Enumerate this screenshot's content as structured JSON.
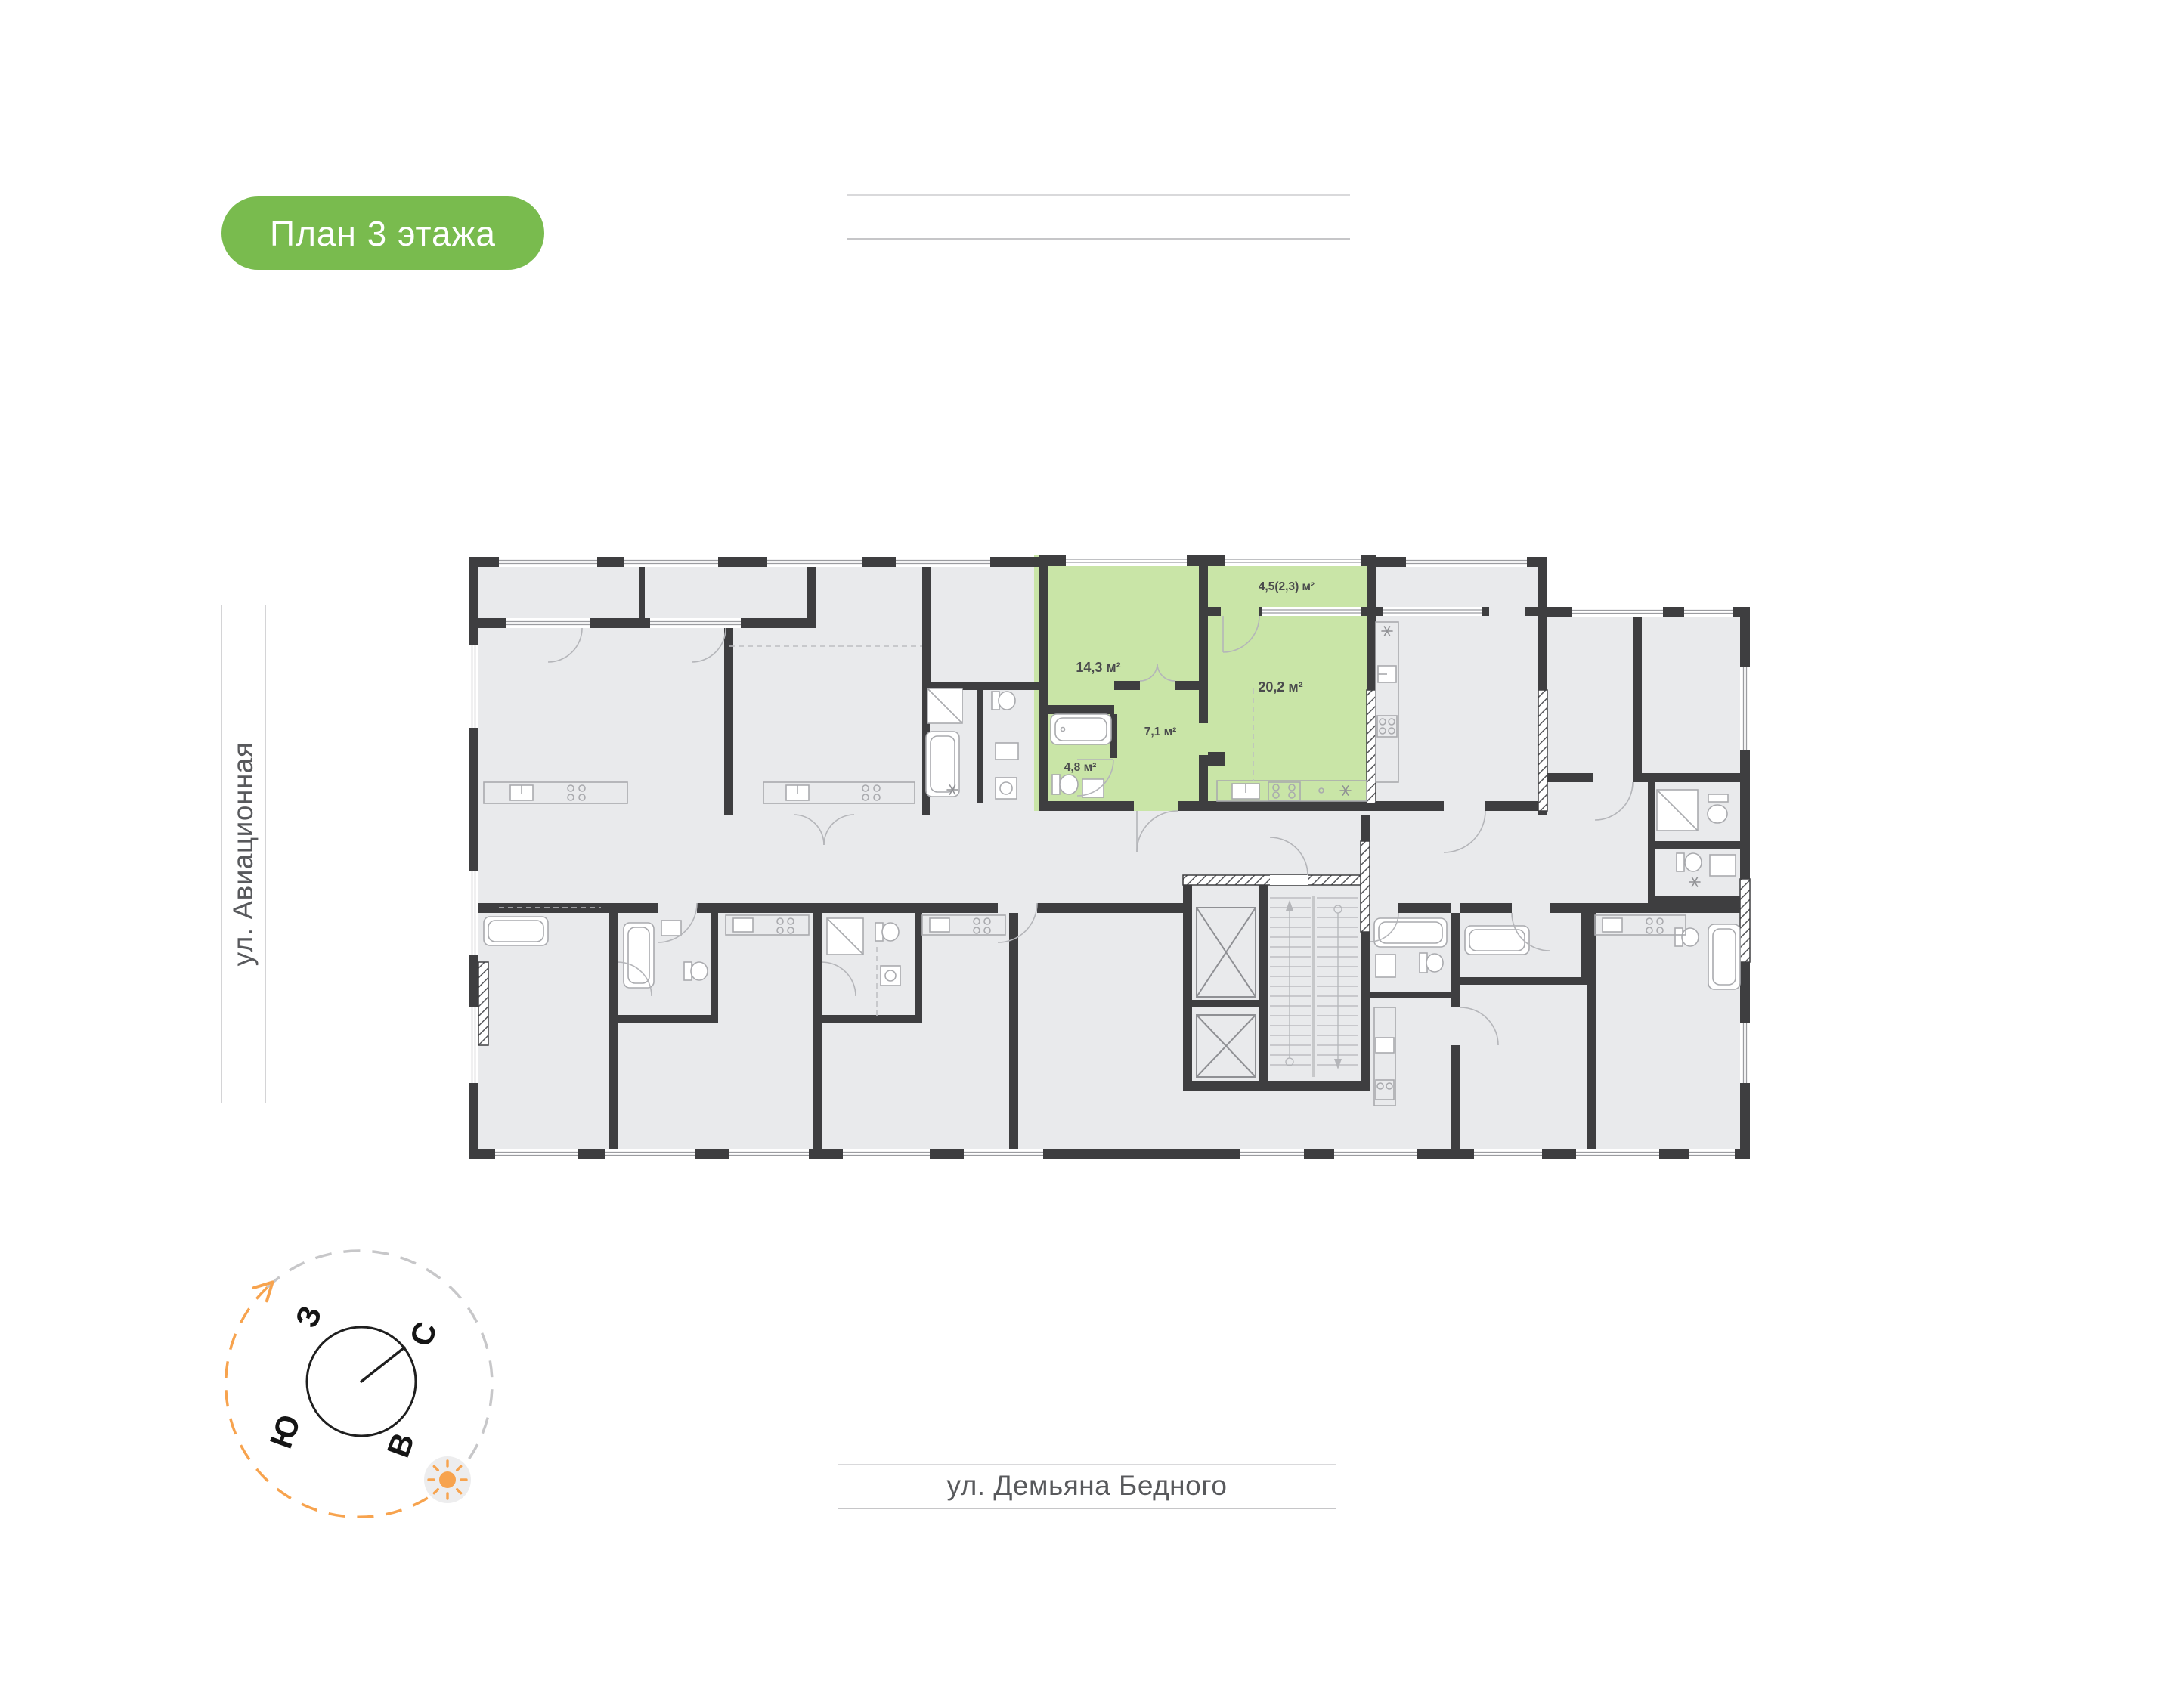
{
  "badge": {
    "label": "План 3 этажа",
    "bg_color": "#79BB4E",
    "text_color": "#ffffff"
  },
  "streets": {
    "left": "ул. Авиационная",
    "bottom": "ул. Демьяна Бедного"
  },
  "compass": {
    "points": {
      "west": "З",
      "north": "С",
      "south": "Ю",
      "east": "В"
    },
    "orange": "#F7A34E",
    "sun_disc": "#ededee"
  },
  "plan": {
    "highlight_color": "#C9E5A7",
    "wall_color": "#3E3E40",
    "floor_color": "#E9EAEC",
    "rooms": [
      {
        "id": "room-living",
        "label": "14,3 м²"
      },
      {
        "id": "room-balcony",
        "label": "4,5(2,3) м²"
      },
      {
        "id": "room-kitchen",
        "label": "20,2 м²"
      },
      {
        "id": "room-hall",
        "label": "7,1 м²"
      },
      {
        "id": "room-bath",
        "label": "4,8 м²"
      }
    ]
  }
}
